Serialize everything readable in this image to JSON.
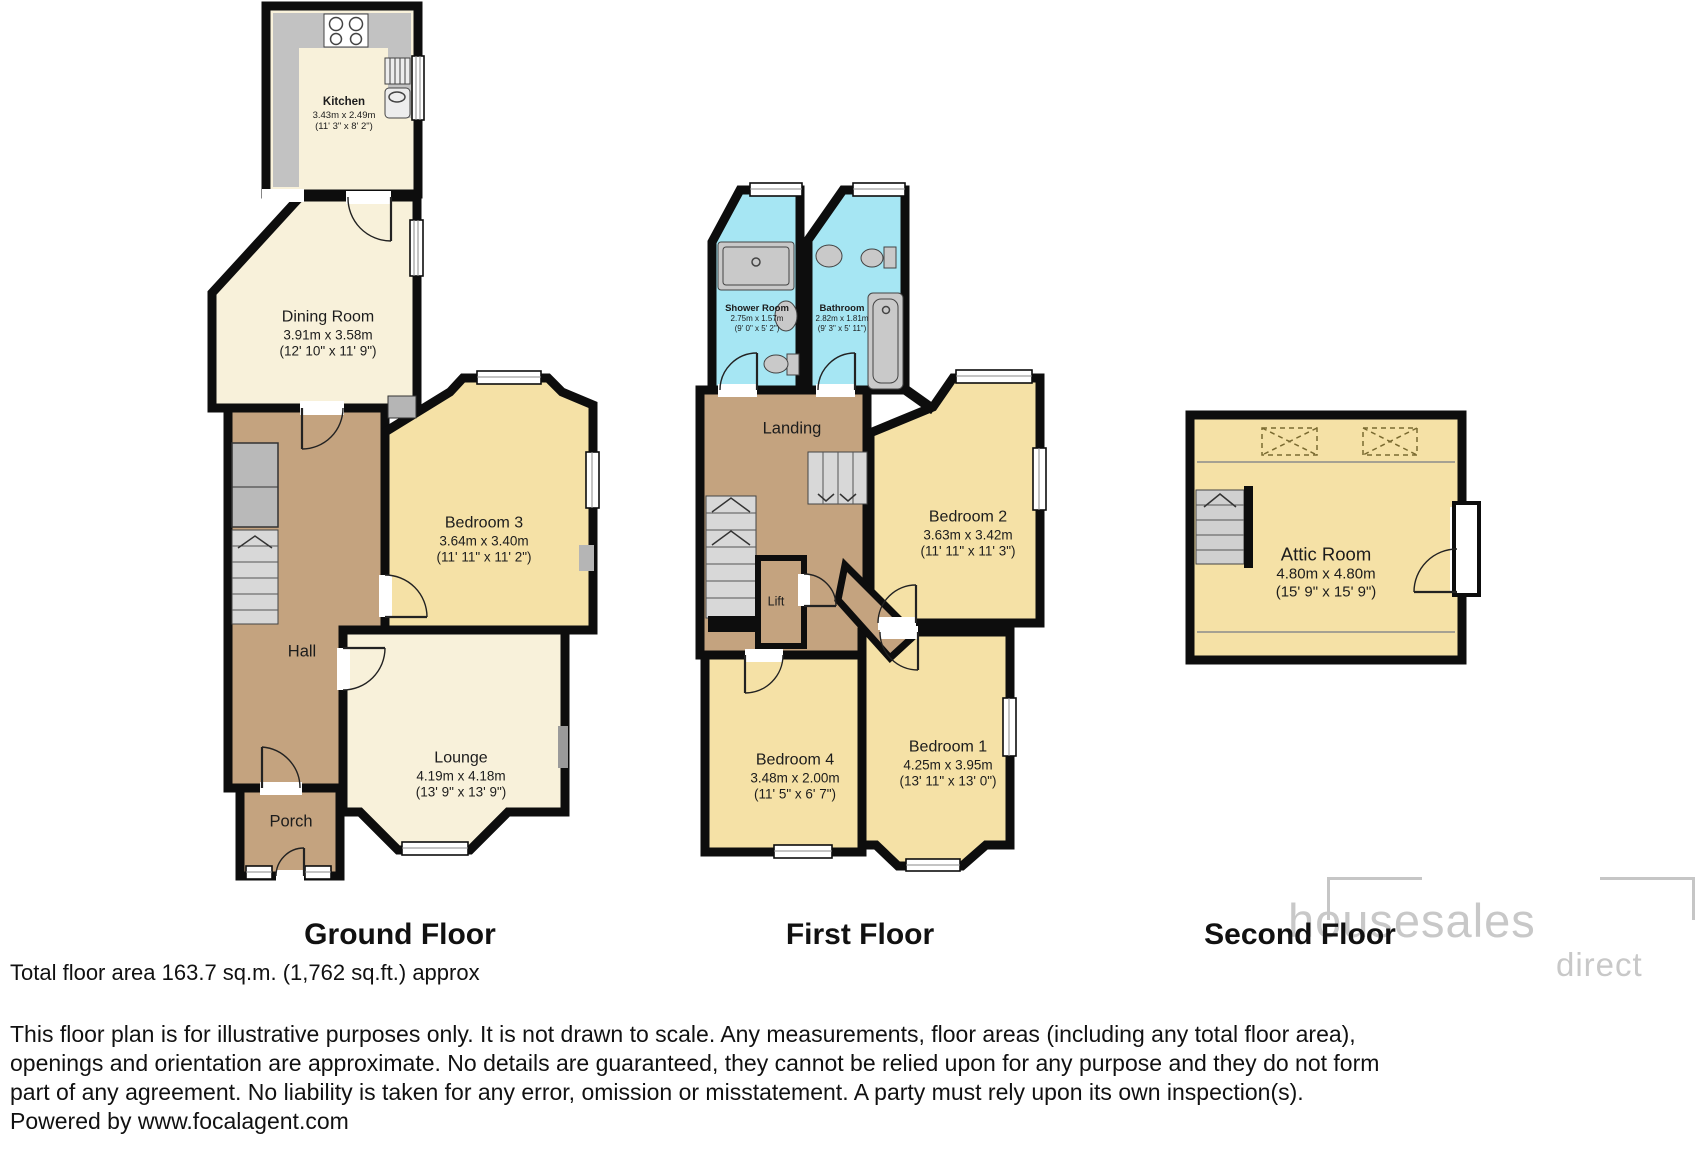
{
  "floors": [
    {
      "label": "Ground Floor",
      "rooms": [
        {
          "name": "Kitchen",
          "metric": "3.43m x 2.49m",
          "imperial": "(11' 3\" x 8' 2\")"
        },
        {
          "name": "Dining Room",
          "metric": "3.91m x 3.58m",
          "imperial": "(12' 10\" x 11' 9\")"
        },
        {
          "name": "Bedroom 3",
          "metric": "3.64m x 3.40m",
          "imperial": "(11' 11\" x 11' 2\")"
        },
        {
          "name": "Hall"
        },
        {
          "name": "Lounge",
          "metric": "4.19m x 4.18m",
          "imperial": "(13' 9\" x 13' 9\")"
        },
        {
          "name": "Porch"
        }
      ]
    },
    {
      "label": "First Floor",
      "rooms": [
        {
          "name": "Shower Room",
          "metric": "2.75m x 1.57m",
          "imperial": "(9' 0\" x 5' 2\")"
        },
        {
          "name": "Bathroom",
          "metric": "2.82m x 1.81m",
          "imperial": "(9' 3\" x 5' 11\")"
        },
        {
          "name": "Landing"
        },
        {
          "name": "Bedroom 2",
          "metric": "3.63m x 3.42m",
          "imperial": "(11' 11\" x 11' 3\")"
        },
        {
          "name": "Lift"
        },
        {
          "name": "Bedroom 4",
          "metric": "3.48m x 2.00m",
          "imperial": "(11' 5\" x 6' 7\")"
        },
        {
          "name": "Bedroom 1",
          "metric": "4.25m x 3.95m",
          "imperial": "(13' 11\" x 13' 0\")"
        }
      ]
    },
    {
      "label": "Second Floor",
      "rooms": [
        {
          "name": "Attic Room",
          "metric": "4.80m x 4.80m",
          "imperial": "(15' 9\" x 15' 9\")"
        }
      ]
    }
  ],
  "footer": {
    "total_area": "Total floor area 163.7 sq.m. (1,762 sq.ft.) approx",
    "disclaimer_lines": [
      "This floor plan is for illustrative purposes only. It is not drawn to scale. Any measurements, floor areas (including any total floor area),",
      "openings and orientation are approximate. No details are guaranteed, they cannot be relied upon for any purpose and they do not form",
      "part of any agreement. No liability is taken for any error, omission or misstatement. A party must rely upon its own inspection(s)."
    ],
    "powered_by": "Powered by www.focalagent.com"
  },
  "logo": {
    "name": "housesales",
    "suffix": "direct"
  },
  "colors": {
    "room_cream": "#f8f1da",
    "room_yellow": "#f5e1a6",
    "hall_brown": "#c4a37f",
    "bath_blue": "#a6e6f3",
    "wall": "#0d0d0d",
    "fixture_gray": "#c9c9c9",
    "logo_gray": "#c8c8c8"
  }
}
